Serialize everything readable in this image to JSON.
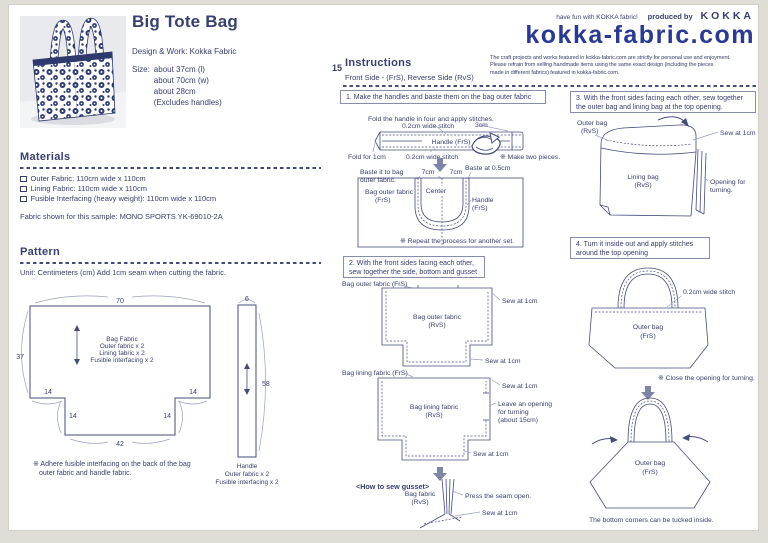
{
  "badge": {
    "number": "15"
  },
  "intro": {
    "title": "Big Tote Bag",
    "design_work": "Design & Work: Kokka Fabric",
    "size_label": "Size:",
    "size_lines": [
      "about 37cm (l)",
      "about 70cm (w)",
      "about 28cm",
      "(Excludes handles)"
    ]
  },
  "brandbar": {
    "tagline": "have fun with KOKKA fabric!",
    "produced_by": "produced by",
    "brand": "KOKKA",
    "logo": "kokka-fabric.com",
    "disclaimer_lines": [
      "The craft projects and works featured in kokka-fabric.com are strictly for personal use and enjoyment.",
      "Please refrain from selling handmade items using the same exact design (including the pieces",
      "made in different fabrics) featured in kokka-fabric.com."
    ]
  },
  "materials": {
    "heading": "Materials",
    "items": [
      "Outer Fabric: 110cm wide x 110cm",
      "Lining Fabric: 110cm wide x 110cm",
      "Fusible Interfacing (heavy weight): 110cm wide x 110cm"
    ],
    "sample_note": "Fabric shown for this sample: MONO SPORTS YK-69010-2A"
  },
  "pattern": {
    "heading": "Pattern",
    "unit_note": "Unit: Centimeters (cm)   Add 1cm seam when cutting the fabric.",
    "bag_piece": {
      "dim_top": "70",
      "dim_left": "37",
      "dim_bottom": "42",
      "dim_notch_left_h": "14",
      "dim_notch_right_h": "14",
      "dim_notch_left_v": "14",
      "dim_notch_right_v": "14",
      "label_lines": [
        "Bag Fabric",
        "Outer fabric x 2",
        "Lining fabric x 2",
        "Fusible interfacing x 2"
      ]
    },
    "handle_piece": {
      "dim_top": "6",
      "dim_right": "58",
      "label_lines": [
        "Handle",
        "Outer fabric x 2",
        "Fusible interfacing x 2"
      ]
    },
    "note_lines": [
      "※ Adhere fusible interfacing on the back of the bag",
      "outer fabric and handle fabric."
    ]
  },
  "instructions": {
    "heading": "Instructions",
    "legend": "Front Side - (FrS), Reverse Side (RvS)",
    "common": {
      "sew_at_1cm": "Sew at 1cm",
      "stitch_02": "0.2cm wide stitch"
    },
    "step1": {
      "title": "1. Make the handles and baste them on the bag outer fabric",
      "fold_caption": "Fold the handle in four and apply stitches.",
      "three_cm": "3cm",
      "handle_frs": "Handle (FrS)",
      "fold_for_1cm": "Fold for 1cm",
      "make_two_note": "※ Make two pieces.",
      "baste_lines": [
        "Baste it to bag",
        "outer fabric."
      ],
      "seven_cm_left": "7cm",
      "seven_cm_right": "7cm",
      "baste_at": "Baste at 0.5cm",
      "center": "Center",
      "bag_outer_lines": [
        "Bag outer fabric",
        "(FrS)"
      ],
      "handle_lines": [
        "Handle",
        "(FrS)"
      ],
      "repeat_note": "※ Repeat the process for another set."
    },
    "step2": {
      "title_lines": [
        "2. With the front sides facing each other,",
        "sew together the side, bottom and gusset"
      ],
      "outer_top_label": "Bag outer fabric (FrS)",
      "outer_center_lines": [
        "Bag outer fabric",
        "(RvS)"
      ],
      "lining_top_label": "Bag lining fabric (FrS)",
      "lining_center_lines": [
        "Bag lining fabric",
        "(RvS)"
      ],
      "opening_lines": [
        "Leave an opening",
        "for turning",
        "(about 15cm)"
      ],
      "gusset_heading": "<How to sew gusset>",
      "gusset_fabric_lines": [
        "Bag fabric",
        "(RvS)"
      ],
      "press_seam": "Press the seam open."
    },
    "step3": {
      "title_lines": [
        "3. With the front sides facing each other, sew together",
        "the  outer bag and lining bag at the top opening."
      ],
      "outer_bag_lines": [
        "Outer bag",
        "(RvS)"
      ],
      "lining_bag_lines": [
        "Lining bag",
        "(RvS)"
      ],
      "opening_lines": [
        "Opening for",
        "turning."
      ]
    },
    "step4": {
      "title_lines": [
        "4. Turn it inside out and apply stitches",
        "around the top opening"
      ],
      "stitch": "0.2cm wide stitch",
      "outer_bag_lines": [
        "Outer bag",
        "(FrS)"
      ],
      "close_note": "※ Close the opening for turning.",
      "final_outer_lines": [
        "Outer bag",
        "(FrS)"
      ],
      "tuck_note": "The bottom corners can be tucked inside."
    }
  }
}
